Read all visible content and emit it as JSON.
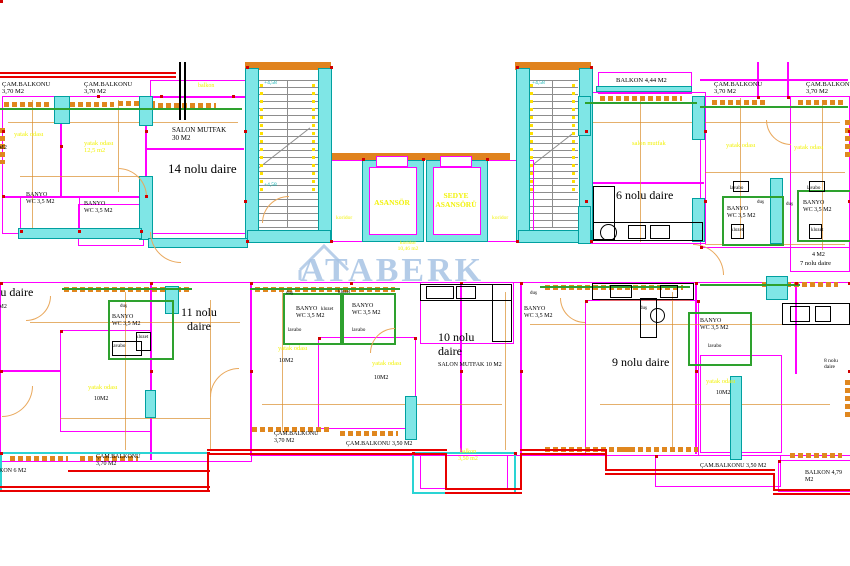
{
  "watermark": {
    "text": "ATABERK",
    "icon": "house-roof-icon"
  },
  "palette": {
    "k": "#000000",
    "y": "#f2f20c",
    "m": "#ff00ff",
    "c": "#00aeae",
    "o": "#d8821e",
    "r": "#ff0000"
  },
  "core": {
    "elevator1": "ASANSÖR",
    "elevator2": "SEDYE\nASANSÖRÜ",
    "corridor": "koridor"
  },
  "labels": [
    {
      "n": "balcony-label",
      "t": "ÇAM.BALKONU\n3,70 M2",
      "x": 2,
      "y": 81,
      "fs": 6.5
    },
    {
      "n": "balcony-label",
      "t": "ÇAM.BALKONU\n3,70 M2",
      "x": 84,
      "y": 81,
      "fs": 6.5
    },
    {
      "n": "room-label",
      "t": "yatak odası",
      "x": 14,
      "y": 131,
      "fs": 6.5,
      "c": "y"
    },
    {
      "n": "room-label",
      "t": "yatak odası\n12,5 m2",
      "x": 84,
      "y": 140,
      "fs": 6.5,
      "c": "y"
    },
    {
      "n": "area-label",
      "t": "30 M2",
      "x": -9,
      "y": 145,
      "fs": 6
    },
    {
      "n": "balcony-label",
      "t": "balkon",
      "x": 198,
      "y": 83,
      "fs": 6,
      "c": "y"
    },
    {
      "n": "room-label",
      "t": "SALON MUTFAK\n30 M2",
      "x": 172,
      "y": 126,
      "fs": 7
    },
    {
      "n": "apartment-label",
      "t": "14 nolu daire",
      "x": 168,
      "y": 162,
      "fs": 13
    },
    {
      "n": "room-label",
      "t": "BANYO\nWC 3,5 M2",
      "x": 26,
      "y": 192,
      "fs": 6
    },
    {
      "n": "room-label",
      "t": "BANYO\nWC 3,5 M2",
      "x": 84,
      "y": 201,
      "fs": 6
    },
    {
      "n": "level-mark",
      "t": "+4,58",
      "x": 264,
      "y": 80,
      "fs": 5.5,
      "c": "c"
    },
    {
      "n": "level-mark",
      "t": "+4,58",
      "x": 264,
      "y": 182,
      "fs": 5.5,
      "c": "c"
    },
    {
      "n": "level-mark",
      "t": "+4,58",
      "x": 532,
      "y": 80,
      "fs": 5.5,
      "c": "c"
    },
    {
      "n": "elevator-label",
      "t": "ASANSÖR",
      "x": 362,
      "y": 199,
      "fs": 7.5,
      "c": "y",
      "w": 60,
      "ta": "center",
      "b": 1
    },
    {
      "n": "elevator-label",
      "t": "SEDYE\nASANSÖRÜ",
      "x": 426,
      "y": 192,
      "fs": 7.5,
      "c": "y",
      "w": 60,
      "ta": "center",
      "b": 1
    },
    {
      "n": "room-label",
      "t": "koridor",
      "x": 336,
      "y": 215,
      "fs": 5.5,
      "c": "y"
    },
    {
      "n": "room-label",
      "t": "koridor",
      "x": 492,
      "y": 215,
      "fs": 5.5,
      "c": "y"
    },
    {
      "n": "room-label",
      "t": "koridor\n10,46 m2",
      "x": 392,
      "y": 240,
      "fs": 5.5,
      "c": "y",
      "w": 32,
      "ta": "center"
    },
    {
      "n": "balcony-label",
      "t": "BALKON 4,44 M2",
      "x": 616,
      "y": 77,
      "fs": 6.5
    },
    {
      "n": "room-label",
      "t": "salon mutfak",
      "x": 632,
      "y": 140,
      "fs": 6.5,
      "c": "y"
    },
    {
      "n": "apartment-label",
      "t": "6 nolu daire",
      "x": 616,
      "y": 189,
      "fs": 12
    },
    {
      "n": "balcony-label",
      "t": "ÇAM.BALKONU\n3,70 M2",
      "x": 714,
      "y": 81,
      "fs": 6.5
    },
    {
      "n": "balcony-label",
      "t": "ÇAM.BALKONU\n3,70 M2",
      "x": 806,
      "y": 81,
      "fs": 6.5
    },
    {
      "n": "room-label",
      "t": "yatak odası",
      "x": 726,
      "y": 142,
      "fs": 6.5,
      "c": "y"
    },
    {
      "n": "room-label",
      "t": "yatak odası",
      "x": 794,
      "y": 144,
      "fs": 6.5,
      "c": "y"
    },
    {
      "n": "fixture-label",
      "t": "lavabo",
      "x": 730,
      "y": 186,
      "fs": 5
    },
    {
      "n": "fixture-label",
      "t": "lavabo",
      "x": 807,
      "y": 186,
      "fs": 5
    },
    {
      "n": "fixture-label",
      "t": "duş",
      "x": 757,
      "y": 200,
      "fs": 5
    },
    {
      "n": "fixture-label",
      "t": "duş",
      "x": 786,
      "y": 202,
      "fs": 5
    },
    {
      "n": "room-label",
      "t": "BANYO\nWC 3,5 M2",
      "x": 727,
      "y": 206,
      "fs": 6
    },
    {
      "n": "room-label",
      "t": "BANYO\nWC 3,5 M2",
      "x": 803,
      "y": 200,
      "fs": 6
    },
    {
      "n": "fixture-label",
      "t": "klozet",
      "x": 731,
      "y": 228,
      "fs": 5
    },
    {
      "n": "fixture-label",
      "t": "klozet",
      "x": 811,
      "y": 228,
      "fs": 5
    },
    {
      "n": "area-label",
      "t": "4 M2",
      "x": 812,
      "y": 252,
      "fs": 6
    },
    {
      "n": "apartment-label",
      "t": "7 nolu daire",
      "x": 800,
      "y": 260,
      "fs": 6.5
    },
    {
      "n": "apartment-label",
      "t": "12 nolu daire",
      "x": -30,
      "y": 286,
      "fs": 12
    },
    {
      "n": "area-label",
      "t": "6 M2",
      "x": -6,
      "y": 304,
      "fs": 6
    },
    {
      "n": "apartment-label",
      "t": "11 nolu\ndaire",
      "x": 176,
      "y": 306,
      "fs": 12,
      "w": 46,
      "ta": "center"
    },
    {
      "n": "fixture-label",
      "t": "duş",
      "x": 120,
      "y": 304,
      "fs": 5
    },
    {
      "n": "room-label",
      "t": "BANYO\nWC 3,5 M2",
      "x": 112,
      "y": 314,
      "fs": 6
    },
    {
      "n": "fixture-label",
      "t": "klozet",
      "x": 136,
      "y": 335,
      "fs": 5
    },
    {
      "n": "fixture-label",
      "t": "lavabo",
      "x": 112,
      "y": 344,
      "fs": 5
    },
    {
      "n": "room-label",
      "t": "yatak odası",
      "x": 88,
      "y": 384,
      "fs": 6.5,
      "c": "y"
    },
    {
      "n": "area-label",
      "t": "10M2",
      "x": 94,
      "y": 396,
      "fs": 6
    },
    {
      "n": "balcony-label",
      "t": "ÇAM.BALKONU\n3,70 M2",
      "x": 96,
      "y": 454,
      "fs": 6
    },
    {
      "n": "balcony-label",
      "t": "BALKON 6 M2",
      "x": -13,
      "y": 468,
      "fs": 6
    },
    {
      "n": "fixture-label",
      "t": "duş",
      "x": 286,
      "y": 291,
      "fs": 5
    },
    {
      "n": "room-label",
      "t": "BANYO\nWC 3,5 M2",
      "x": 296,
      "y": 306,
      "fs": 6
    },
    {
      "n": "fixture-label",
      "t": "klozet",
      "x": 321,
      "y": 307,
      "fs": 5
    },
    {
      "n": "fixture-label",
      "t": "lavabo",
      "x": 288,
      "y": 328,
      "fs": 5
    },
    {
      "n": "room-label",
      "t": "BANYO\nWC 3,5 M2",
      "x": 352,
      "y": 303,
      "fs": 6
    },
    {
      "n": "fixture-label",
      "t": "klozet",
      "x": 338,
      "y": 290,
      "fs": 5
    },
    {
      "n": "fixture-label",
      "t": "lavabo",
      "x": 352,
      "y": 328,
      "fs": 5
    },
    {
      "n": "room-label",
      "t": "yatak odası",
      "x": 278,
      "y": 345,
      "fs": 6.5,
      "c": "y"
    },
    {
      "n": "area-label",
      "t": "10M2",
      "x": 279,
      "y": 358,
      "fs": 6
    },
    {
      "n": "room-label",
      "t": "yatak odası",
      "x": 372,
      "y": 360,
      "fs": 6.5,
      "c": "y"
    },
    {
      "n": "area-label",
      "t": "10M2",
      "x": 374,
      "y": 375,
      "fs": 6
    },
    {
      "n": "apartment-label",
      "t": "10 nolu\ndaire",
      "x": 438,
      "y": 331,
      "fs": 12
    },
    {
      "n": "room-label",
      "t": "SALON MUTFAK  10 M2",
      "x": 438,
      "y": 362,
      "fs": 6
    },
    {
      "n": "fixture-label",
      "t": "duş",
      "x": 530,
      "y": 291,
      "fs": 5
    },
    {
      "n": "room-label",
      "t": "BANYO\nWC 3,5 M2",
      "x": 524,
      "y": 306,
      "fs": 6
    },
    {
      "n": "balcony-label",
      "t": "ÇAM.BALKONU\n3,70 M2",
      "x": 274,
      "y": 431,
      "fs": 6
    },
    {
      "n": "balcony-label",
      "t": "ÇAM.BALKONU 3,50 M2",
      "x": 346,
      "y": 441,
      "fs": 6
    },
    {
      "n": "balcony-label",
      "t": "balkon\n3,50 m2",
      "x": 448,
      "y": 449,
      "fs": 6,
      "c": "y",
      "w": 40,
      "ta": "center"
    },
    {
      "n": "apartment-label",
      "t": "9 nolu daire",
      "x": 612,
      "y": 356,
      "fs": 12
    },
    {
      "n": "fixture-label",
      "t": "duş",
      "x": 640,
      "y": 306,
      "fs": 5
    },
    {
      "n": "room-label",
      "t": "BANYO\nWC 3,5 M2",
      "x": 700,
      "y": 318,
      "fs": 6
    },
    {
      "n": "fixture-label",
      "t": "lavabo",
      "x": 708,
      "y": 344,
      "fs": 5
    },
    {
      "n": "room-label",
      "t": "yatak odası",
      "x": 706,
      "y": 378,
      "fs": 6.5,
      "c": "y"
    },
    {
      "n": "area-label",
      "t": "10M2",
      "x": 716,
      "y": 390,
      "fs": 6
    },
    {
      "n": "apartment-label",
      "t": "8 nolu daire",
      "x": 824,
      "y": 358,
      "fs": 5.5
    },
    {
      "n": "balcony-label",
      "t": "ÇAM.BALKONU 3,50 M2",
      "x": 700,
      "y": 463,
      "fs": 6
    },
    {
      "n": "balcony-label",
      "t": "BALKON 4,79 M2",
      "x": 805,
      "y": 470,
      "fs": 6
    }
  ]
}
